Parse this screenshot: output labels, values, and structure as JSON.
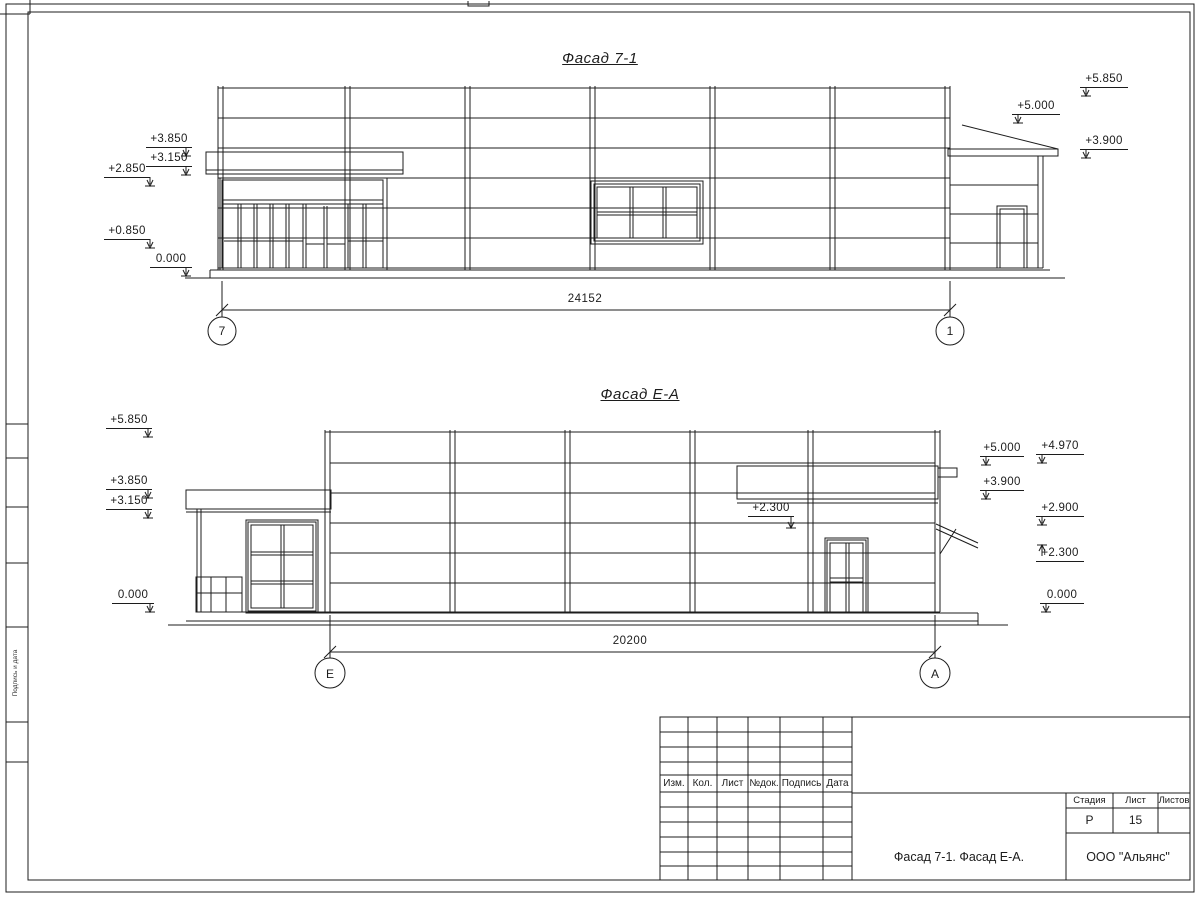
{
  "drawing": {
    "facade1": {
      "title": "Фасад 7-1",
      "dimension": "24152",
      "axis_left": "7",
      "axis_right": "1",
      "marks_left": [
        "+3.850",
        "+3.150",
        "+2.850",
        "+0.850",
        "0.000"
      ],
      "marks_right": [
        "+5.850",
        "+5.000",
        "+3.900"
      ]
    },
    "facade2": {
      "title": "Фасад Е-А",
      "dimension": "20200",
      "axis_left": "Е",
      "axis_right": "А",
      "marks_left": [
        "+5.850",
        "+3.850",
        "+3.150",
        "0.000"
      ],
      "marks_right": [
        "+5.000",
        "+4.970",
        "+3.900",
        "+2.900",
        "+2.300",
        "0.000"
      ],
      "mark_middle": "+2.300"
    },
    "title_block": {
      "columns": [
        "Изм.",
        "Кол.",
        "Лист",
        "№док.",
        "Подпись",
        "Дата"
      ],
      "stage_label": "Стадия",
      "sheet_label": "Лист",
      "sheets_label": "Листов",
      "stage_value": "Р",
      "sheet_value": "15",
      "drawing_name": "Фасад 7-1. Фасад Е-А.",
      "company": "ООО \"Альянс\""
    },
    "side_stamp": {
      "vertical_text": "Подпись и дата"
    },
    "colors": {
      "line": "#1c1c1c",
      "paper": "#ffffff"
    }
  }
}
